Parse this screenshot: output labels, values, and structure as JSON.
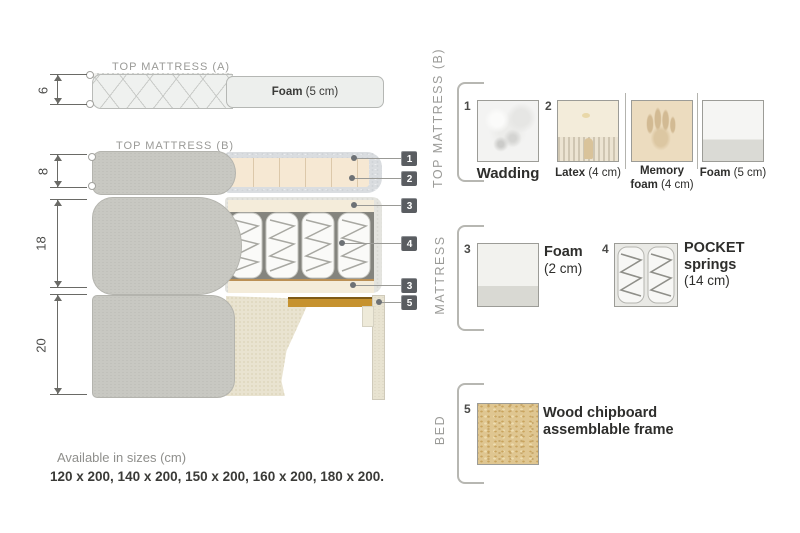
{
  "diagram": {
    "top_a_label": "TOP MATTRESS (A)",
    "top_b_label": "TOP MATTRESS (B)",
    "foam_a_bold": "Foam",
    "foam_a_rest": " (5 cm)",
    "dim_top_a": "6",
    "dim_top_b": "8",
    "dim_mattress": "18",
    "dim_bed": "20",
    "callouts": {
      "c1": "1",
      "c2": "2",
      "c3a": "3",
      "c4": "4",
      "c3b": "3",
      "c5": "5"
    }
  },
  "legend": {
    "top_b": {
      "title": "TOP MATTRESS (B)",
      "item1_num": "1",
      "item1_label": "Wadding",
      "item2_num": "2",
      "item2_bold": "Latex",
      "item2_rest": " (4 cm)",
      "item3_line1": "Memory",
      "item3_line2_bold": "foam",
      "item3_line2_rest": " (4 cm)",
      "item4_bold": "Foam",
      "item4_rest": " (5 cm)"
    },
    "mattress": {
      "title": "MATTRESS",
      "item1_num": "3",
      "item1_bold": "Foam",
      "item1_rest": "(2 cm)",
      "item2_num": "4",
      "item2_line1": "POCKET",
      "item2_line2": "springs",
      "item2_line3": "(14 cm)"
    },
    "bed": {
      "title": "BED",
      "item1_num": "5",
      "item1_line1": "Wood chipboard",
      "item1_line2": "assemblable frame"
    }
  },
  "footer": {
    "available": "Available in sizes (cm)",
    "sizes": "120 x 200, 140 x 200, 150 x 200, 160 x 200, 180 x 200."
  },
  "colors": {
    "callout_box": "#5a5d61",
    "cover_gray": "#c8c8c2",
    "foam_cream": "#f6e8d3",
    "wood_slat": "#c6922f",
    "side_fabric": "#e4e4df",
    "label_gray": "#9a9a97",
    "text_dark": "#2e2e2c"
  }
}
